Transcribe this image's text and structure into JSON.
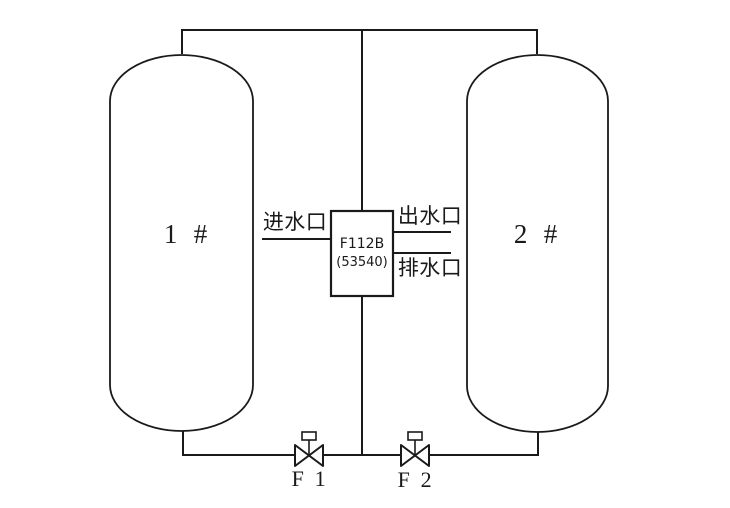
{
  "diagram": {
    "type": "piping-diagram",
    "colors": {
      "line": "#1a1a1a",
      "background": "#ffffff"
    },
    "tanks": [
      {
        "label": "1 #"
      },
      {
        "label": "2 #"
      }
    ],
    "controller": {
      "model": "F112B",
      "code": "(53540)"
    },
    "ports": {
      "inlet_label": "进水口",
      "outlet_label": "出水口",
      "drain_label": "排水口"
    },
    "valves": [
      {
        "label": "F 1"
      },
      {
        "label": "F 2"
      }
    ]
  }
}
